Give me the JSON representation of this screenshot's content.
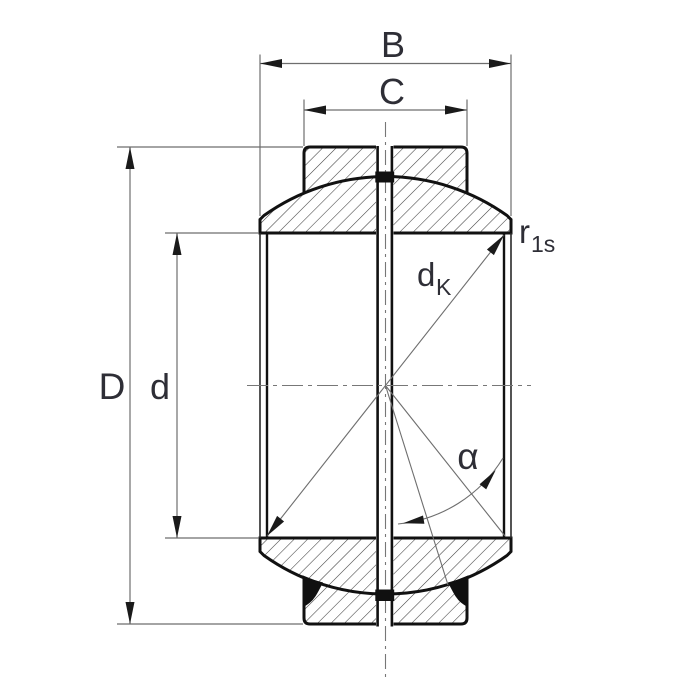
{
  "title": "Spherical plain bearing cross-section drawing",
  "labels": {
    "outer_width": "B",
    "inner_width": "C",
    "outside_diameter": "D",
    "bore_diameter": "d",
    "sphere_diameter_main": "d",
    "sphere_diameter_sub": "K",
    "corner_radius_main": "r",
    "corner_radius_sub": "1s",
    "tilt_angle": "α"
  },
  "colors": {
    "background": "#ffffff",
    "outline": "#111111",
    "hatch_line": "#3f3f3f",
    "dimension_line": "#6e6e6e",
    "centerline": "#777777",
    "arrowhead": "#1a1a1a",
    "seal_fill": "#101010",
    "text": "#2e2e36"
  }
}
